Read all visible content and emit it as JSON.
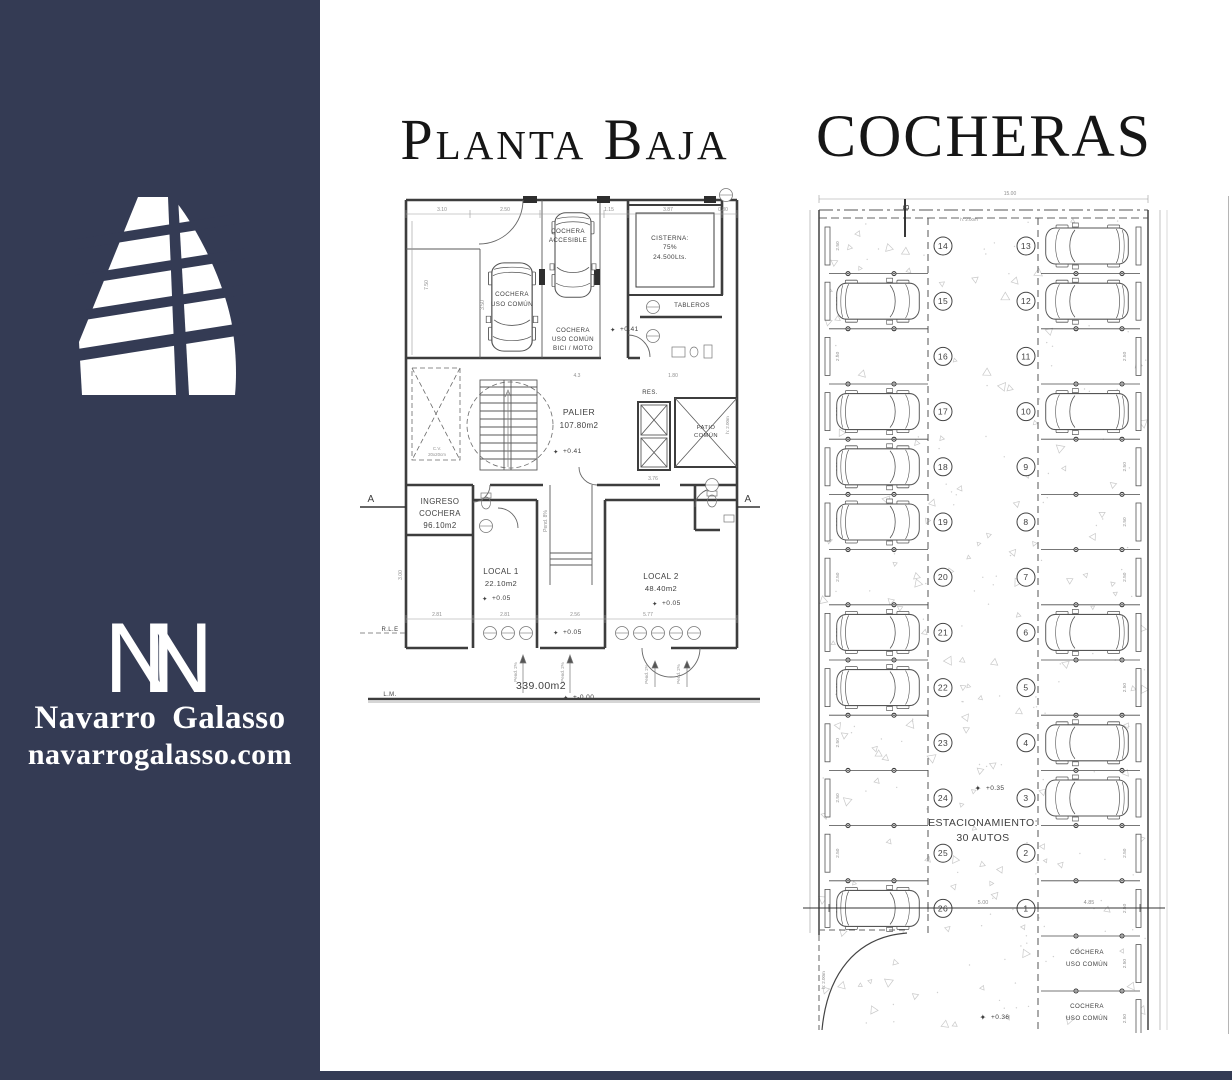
{
  "colors": {
    "sidebar_navy": "#343b54",
    "title_text": "#161616",
    "plan_line": "#3d3d3d",
    "dim_gray": "#8f8f8f",
    "stipple_gray": "#c9c9c9"
  },
  "glyphs": {
    "level_mark": "✦",
    "monogram_letter": "N"
  },
  "sidebar": {
    "brand_name": "Navarro Galasso",
    "website": "navarrogalasso.com"
  },
  "titles": {
    "left": "Planta Baja",
    "right": "COCHERAS"
  },
  "planta_baja": {
    "cochera_accesible": [
      "COCHERA",
      "ACCESIBLE"
    ],
    "cochera_uso_comun": [
      "COCHERA",
      "USO COMÚN"
    ],
    "cisterna": [
      "CISTERNA:",
      "75%",
      "24.500Lts."
    ],
    "tableros": "TABLEROS",
    "cochera_bici": [
      "COCHERA",
      "USO COMÚN",
      "BICI / MOTO"
    ],
    "palier": [
      "PALIER",
      "107.80m2"
    ],
    "ingreso_cochera": [
      "INGRESO",
      "COCHERA",
      "96.10m2"
    ],
    "local_1": [
      "LOCAL 1",
      "22.10m2"
    ],
    "local_2": [
      "LOCAL 2",
      "48.40m2"
    ],
    "patio_comun": [
      "PATIO",
      "COMÚN"
    ],
    "res": "RES.",
    "level_041": "+0.41",
    "level_005": "+0.05",
    "level_000": "+-0.00",
    "area_total": "339.00m2",
    "rle": "R.L.E",
    "lm": "L.M.",
    "section_marker": "A",
    "cv_column": [
      "C.V.",
      "20x20cm"
    ],
    "pend_8": "Pend. 8%",
    "pend_2": "Pend. 2%",
    "h_200": "h: 2.00m",
    "dims_top": [
      "3.10",
      "2.50",
      "1.15",
      "3.87",
      "0.80"
    ],
    "dims_left": [
      "7.50",
      "3.50",
      "3.00"
    ],
    "dims_mid": [
      "2.81",
      "2.81",
      "2.56",
      "5.77"
    ],
    "dims_inner": [
      "4.3",
      "1.80",
      "3.76"
    ]
  },
  "cocheras": {
    "overall_width_dim": "15.00",
    "section_marker": "B",
    "lane_height": "h: 2.00m",
    "entry_height": "h: 2.00m",
    "spot_depth_dim": "2.50",
    "note": [
      "ESTACIONAMIENTO:",
      "30 AUTOS"
    ],
    "level_035": "+0.35",
    "level_036": "+0.36",
    "cochera_uso_comun_labels": [
      [
        "COCHERA",
        "USO COMÚN"
      ],
      [
        "COCHERA",
        "USO COMÚN"
      ]
    ],
    "row_dims": [
      "4.85",
      "5.00",
      "4.85"
    ],
    "left_spots": [
      {
        "number": "14",
        "car": false
      },
      {
        "number": "15",
        "car": true
      },
      {
        "number": "16",
        "car": false
      },
      {
        "number": "17",
        "car": true
      },
      {
        "number": "18",
        "car": true
      },
      {
        "number": "19",
        "car": true
      },
      {
        "number": "20",
        "car": false
      },
      {
        "number": "21",
        "car": true
      },
      {
        "number": "22",
        "car": true
      },
      {
        "number": "23",
        "car": false
      },
      {
        "number": "24",
        "car": false
      },
      {
        "number": "25",
        "car": false
      },
      {
        "number": "26",
        "car": true
      }
    ],
    "right_spots": [
      {
        "number": "13",
        "car": true
      },
      {
        "number": "12",
        "car": true
      },
      {
        "number": "11",
        "car": false
      },
      {
        "number": "10",
        "car": true
      },
      {
        "number": "9",
        "car": false
      },
      {
        "number": "8",
        "car": false
      },
      {
        "number": "7",
        "car": false
      },
      {
        "number": "6",
        "car": true
      },
      {
        "number": "5",
        "car": false
      },
      {
        "number": "4",
        "car": true
      },
      {
        "number": "3",
        "car": true
      },
      {
        "number": "2",
        "car": false
      },
      {
        "number": "1",
        "car": false
      }
    ]
  }
}
